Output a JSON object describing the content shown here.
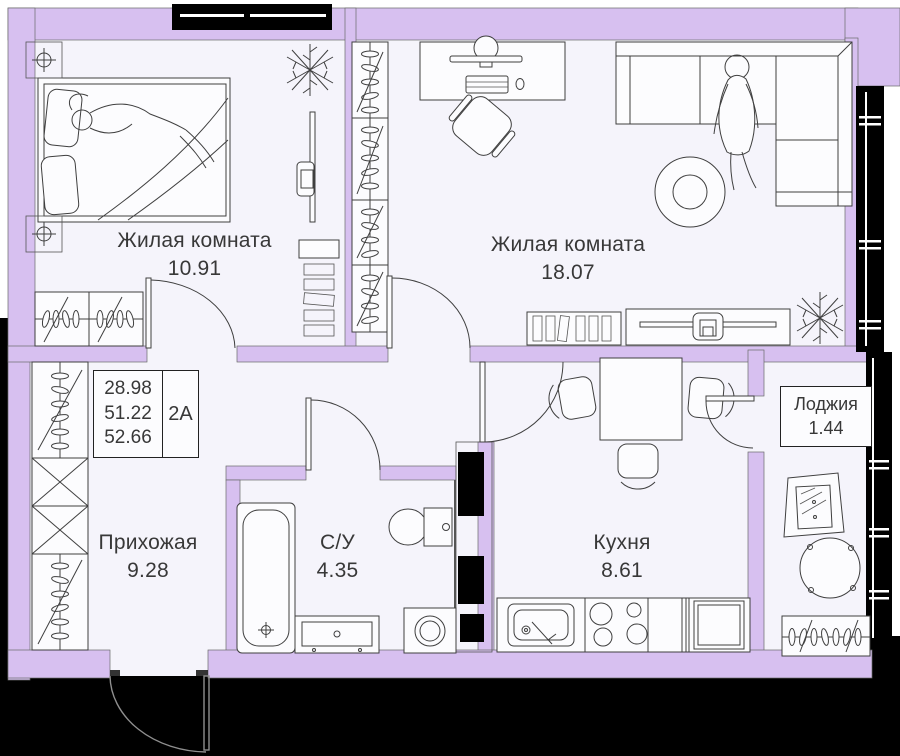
{
  "rooms": [
    {
      "name": "Жилая комната",
      "area": "10.91"
    },
    {
      "name": "Жилая комната",
      "area": "18.07"
    },
    {
      "name": "Прихожая",
      "area": "9.28"
    },
    {
      "name": "С/У",
      "area": "4.35"
    },
    {
      "name": "Кухня",
      "area": "8.61"
    },
    {
      "name": "Лоджия",
      "area": "1.44"
    }
  ],
  "info_box": {
    "values": [
      "28.98",
      "51.22",
      "52.66"
    ],
    "code": "2А"
  },
  "colors": {
    "wall": "#d7c0f0",
    "floor": "#f5f4fb",
    "exterior": "#000000",
    "line": "#3f3f3f"
  }
}
